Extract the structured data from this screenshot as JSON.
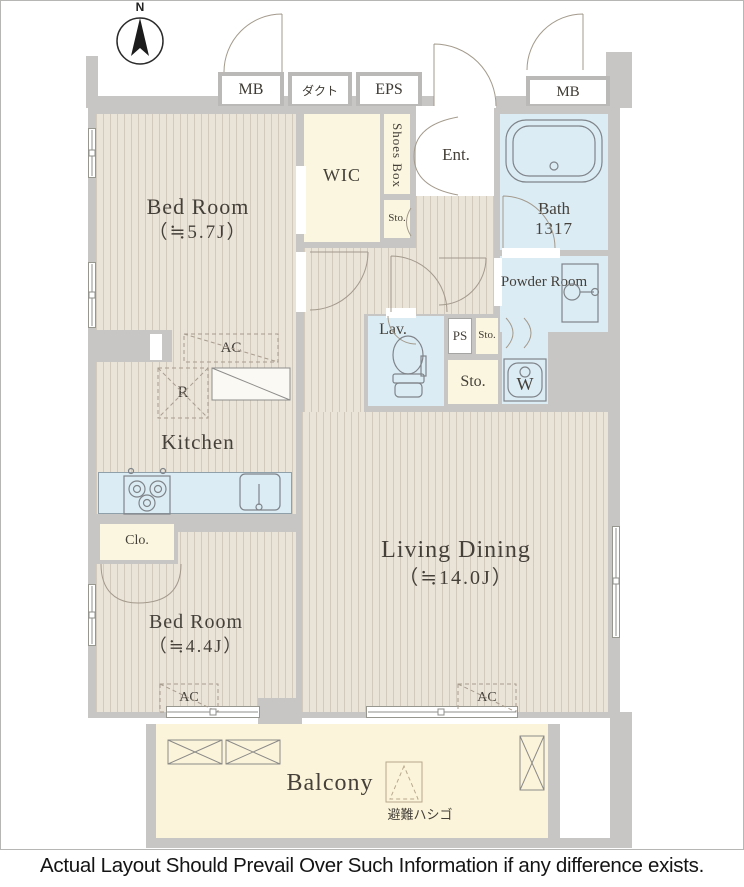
{
  "disclaimer": "Actual Layout Should Prevail Over Such Information if any difference exists.",
  "compass": {
    "north_label": "N"
  },
  "service_boxes": {
    "mb_left": "MB",
    "duct": "ダクト",
    "eps": "EPS",
    "mb_right": "MB"
  },
  "rooms": {
    "bedroom_main": {
      "name": "Bed Room",
      "size": "（≒5.7J）"
    },
    "bedroom_second": {
      "name": "Bed Room",
      "size": "（≒4.4J）"
    },
    "living_dining": {
      "name": "Living Dining",
      "size": "（≒14.0J）"
    },
    "kitchen": {
      "name": "Kitchen"
    },
    "walk_in_closet": {
      "name": "WIC"
    },
    "shoes_box": {
      "name": "Shoes Box"
    },
    "entrance": {
      "name": "Ent."
    },
    "bathroom": {
      "name": "Bath",
      "size": "1317"
    },
    "powder_room": {
      "name": "Powder Room"
    },
    "lavatory": {
      "name": "Lav."
    },
    "closet": {
      "name": "Clo."
    },
    "balcony": {
      "name": "Balcony"
    }
  },
  "fixtures": {
    "storage_entrance": "Sto.",
    "storage_hall_small": "Sto.",
    "storage_hall_large": "Sto.",
    "pipe_space": "PS",
    "washing_machine": "W",
    "refrigerator_space": "R",
    "ac_kitchen": "AC",
    "ac_bedroom_second": "AC",
    "ac_living": "AC",
    "evacuation_ladder": "避難ハシゴ"
  },
  "colors": {
    "wall": "#c7c6c4",
    "floor_wood_base": "#eae3d8",
    "wet_area": "#dcecf5",
    "storage_cream": "#fbf6df",
    "balcony_floor": "#fcf4da",
    "label_ink": "#45413a"
  }
}
